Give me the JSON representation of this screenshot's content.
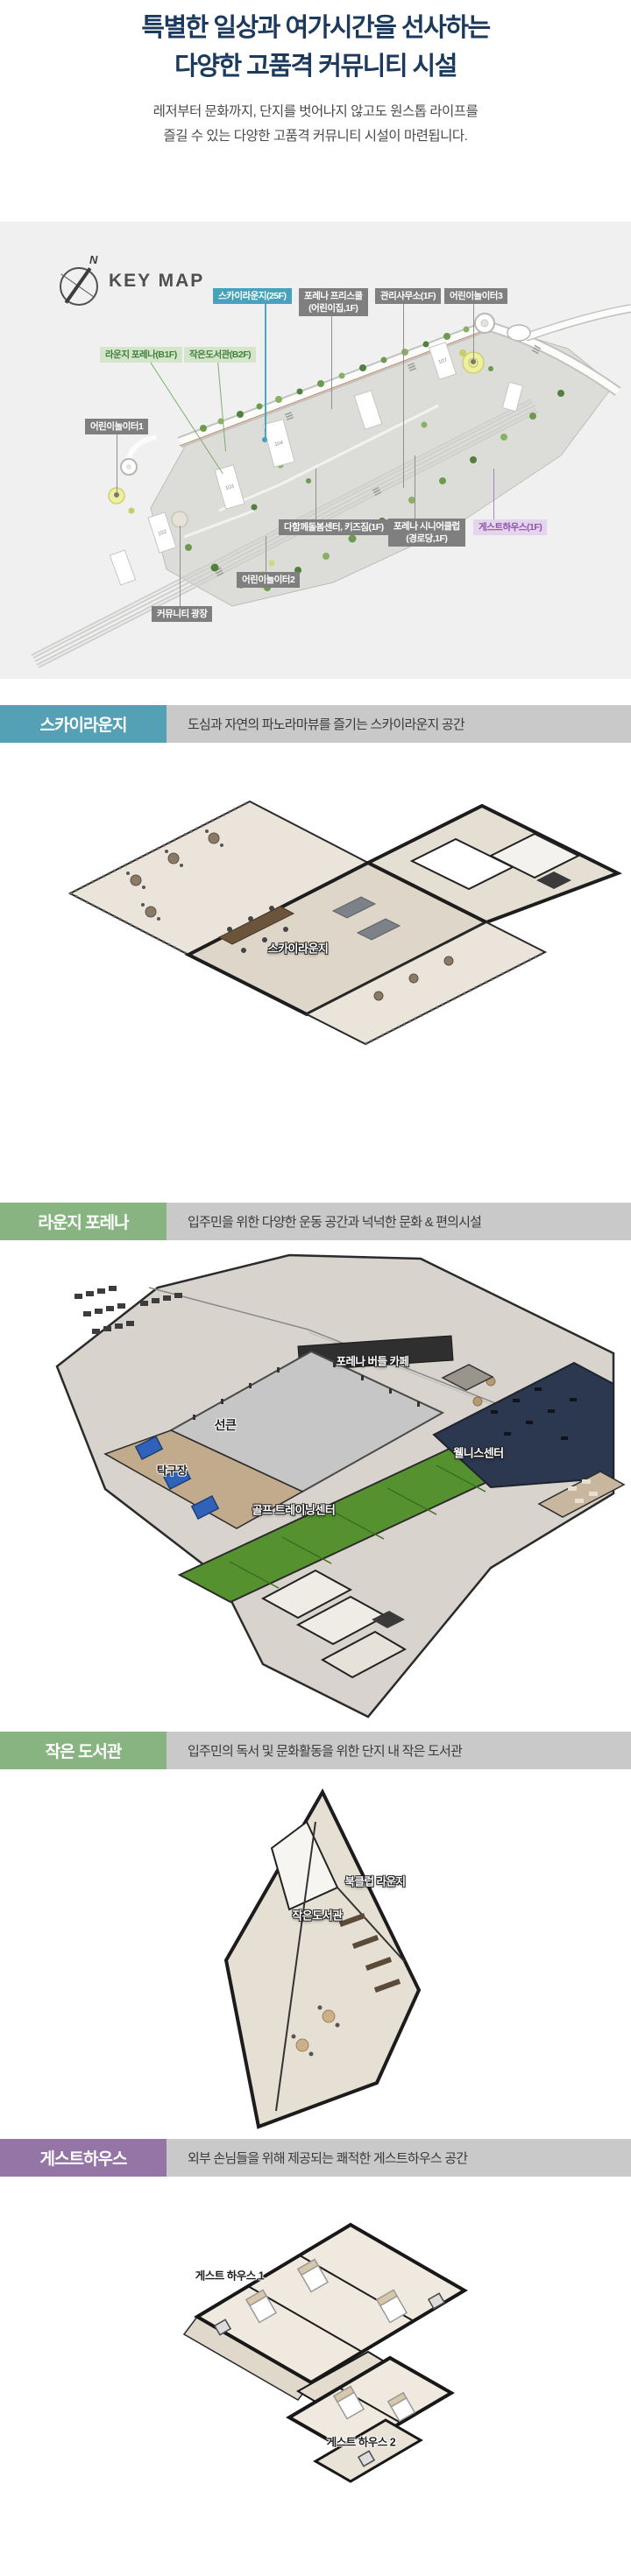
{
  "title": {
    "line1": "특별한 일상과 여가시간을 선사하는",
    "line2": "다양한 고품격 커뮤니티 시설"
  },
  "subtitle": {
    "line1": "레저부터 문화까지, 단지를 벗어나지 않고도 원스톱 라이프를",
    "line2": "즐길 수 있는 다양한 고품격 커뮤니티 시설이 마련됩니다."
  },
  "keymap": {
    "compass_n": "N",
    "heading": "KEY MAP",
    "labels": [
      {
        "text": "스카이라운지(25F)",
        "variant": "teal"
      },
      {
        "text": "포레나 프리스쿨",
        "text2": "(어린이집,1F)",
        "variant": "gray"
      },
      {
        "text": "관리사무소(1F)",
        "variant": "gray"
      },
      {
        "text": "어린이놀이터3",
        "variant": "gray"
      },
      {
        "text": "라운지 포레나(B1F)",
        "variant": "green"
      },
      {
        "text": "작은도서관(B2F)",
        "variant": "green"
      },
      {
        "text": "어린이놀이터1",
        "variant": "gray"
      },
      {
        "text": "다함께돌봄센터, 키즈짐(1F)",
        "variant": "gray"
      },
      {
        "text": "포레나 시니어클럽",
        "text2": "(경로당,1F)",
        "variant": "gray"
      },
      {
        "text": "게스트하우스(1F)",
        "variant": "purple"
      },
      {
        "text": "어린이놀이터2",
        "variant": "gray"
      },
      {
        "text": "커뮤니티 광장",
        "variant": "gray"
      }
    ],
    "building_numbers": [
      "102",
      "103",
      "104",
      "107"
    ]
  },
  "sections": [
    {
      "name": "스카이라운지",
      "description": "도심과 자연의 파노라마뷰를 즐기는 스카이라운지 공간",
      "accent": "#54a0b4",
      "plan_labels": [
        "스카이라운지"
      ]
    },
    {
      "name": "라운지 포레나",
      "description": "입주민을 위한 다양한 운동 공간과 넉넉한 문화 & 편의시설",
      "accent": "#87b480",
      "plan_labels": [
        "포레나 버들 카페",
        "선큰",
        "탁구장",
        "골프 트레이닝센터",
        "웰니스센터"
      ]
    },
    {
      "name": "작은 도서관",
      "description": "입주민의 독서 및 문화활동을 위한 단지 내 작은 도서관",
      "accent": "#87b480",
      "plan_labels": [
        "북클럽 라운지",
        "작은도서관"
      ]
    },
    {
      "name": "게스트하우스",
      "description": "외부 손님들을 위해 제공되는 쾌적한 게스트하우스 공간",
      "accent": "#9574a6",
      "plan_labels": [
        "게스트 하우스 1",
        "게스트 하우스 2"
      ]
    }
  ],
  "colors": {
    "title_navy": "#1c3a5e",
    "teal": "#54a0b4",
    "green": "#87b480",
    "purple": "#9574a6",
    "map_gray_label": "#7f7f7f",
    "header_bar": "#c9c9c9",
    "map_background": "#f0f0f1"
  }
}
